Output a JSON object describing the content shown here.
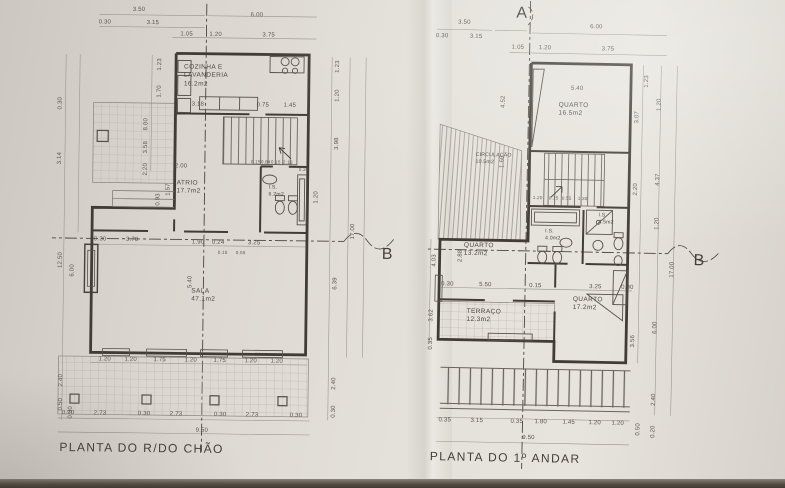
{
  "colors": {
    "paper": "#e4e1da",
    "wall_line": "#413d35",
    "fixture_line": "#55504a",
    "dim_line": "#969187",
    "text": "#4e4a42"
  },
  "markers": {
    "a": "A",
    "b_ground": "B",
    "b_first": "B"
  },
  "plans": [
    {
      "title": "PLANTA DO R/DO CHÃO",
      "rooms": {
        "kitchen": {
          "name1": "COZINHA E",
          "name2": "LAVANDERIA",
          "area": "16.2m2"
        },
        "atrium": {
          "name": "ATRIO",
          "area": "17.7m2"
        },
        "wc": {
          "name": "I.S.",
          "area": "6.2m2"
        },
        "living": {
          "name": "SALA",
          "area": "47.1m2"
        }
      },
      "dims": {
        "top": [
          "3.50",
          "0.30",
          "3.15",
          "6.00",
          "1.05",
          "1.20",
          "3.75"
        ],
        "left": [
          "1.23",
          "1.70",
          "8.00",
          "3.58",
          "2.20",
          "0.30",
          "3.14",
          "0.93",
          "1.57",
          "12.50",
          "6.00",
          "2.40",
          "0.50",
          "0.30"
        ],
        "right": [
          "1.23",
          "1.20",
          "3.98",
          "17.00",
          "6.39",
          "2.40",
          "0.30"
        ],
        "inner": [
          "3.18",
          "0.75",
          "1.45",
          "2.00",
          "0.15",
          "0.84",
          "0.15",
          "2.16",
          "0.36",
          "1.20",
          "0.30",
          "3.78",
          "1.90",
          "0.24",
          "3.25",
          "0.15",
          "0.55",
          "5.40"
        ],
        "bwin": [
          "1.20",
          "1.20",
          "1.75",
          "1.20",
          "1.75",
          "1.20",
          "1.20"
        ],
        "bpl": [
          "0.30",
          "2.73",
          "0.30",
          "2.73",
          "0.30",
          "2.73",
          "0.30"
        ],
        "total": "9.50"
      }
    },
    {
      "title": "PLANTA DO 1º ANDAR",
      "rooms": {
        "bedroom1": {
          "name": "QUARTO",
          "area": "16.5m2"
        },
        "circulation": {
          "name": "CIRCULAÇÃO",
          "area": "10.5m2"
        },
        "wc1": {
          "name": "I.S.",
          "area": "4.0m2"
        },
        "wc2": {
          "name": "I.S.",
          "area": "4.5m2"
        },
        "bedroom2": {
          "name": "QUARTO",
          "area": "13.2m2"
        },
        "bedroom3": {
          "name": "QUARTO",
          "area": "17.2m2"
        },
        "terrace": {
          "name": "TERRAÇO",
          "area": "12.3m2"
        }
      },
      "dims": {
        "top": [
          "3.50",
          "0.30",
          "3.15",
          "6.00",
          "1.05",
          "1.20",
          "3.75"
        ],
        "left": [
          "4.52",
          "1.60",
          "4.03",
          "2.88",
          "3.62",
          "0.35"
        ],
        "right": [
          "1.23",
          "1.20",
          "3.07",
          "2.20",
          "4.37",
          "1.20",
          "17.00",
          "6.00",
          "3.56",
          "2.40",
          "0.50",
          "0.20"
        ],
        "inner": [
          "5.40",
          "0.30",
          "5.50",
          "0.15",
          "3.25",
          "0.30",
          "1.20",
          "0.15",
          "0.55",
          "1.30"
        ],
        "bottom": [
          "0.35",
          "3.15",
          "0.35",
          "1.80",
          "1.45",
          "1.20",
          "1.20"
        ],
        "total": "9.50"
      }
    }
  ]
}
